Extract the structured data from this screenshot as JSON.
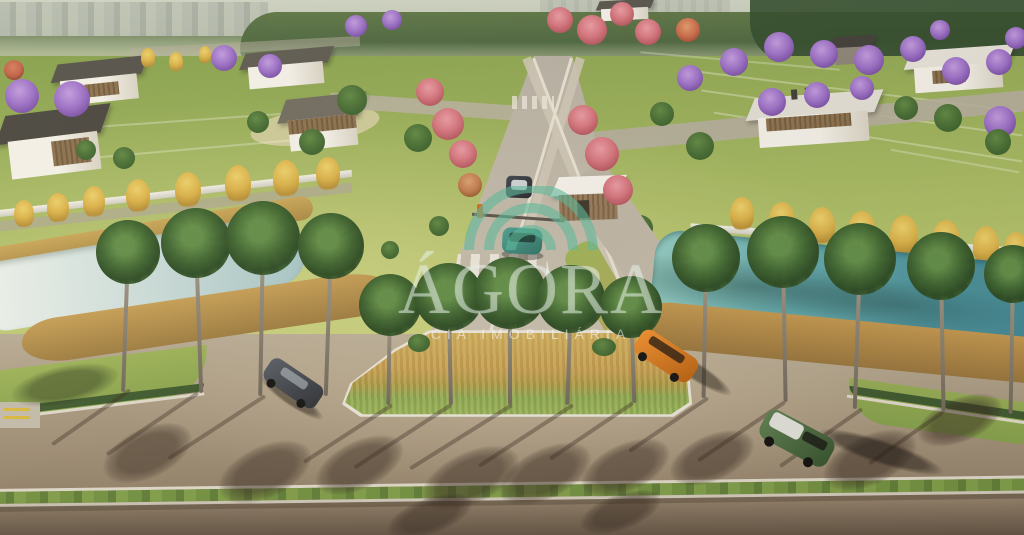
{
  "media": {
    "kind": "aerial 3D architectural rendering",
    "subject": "Entrance of a master-planned residential land development: tree-lined boulevard with gatehouse and crosswalk, central palm island, twin ornamental lakes with golden reed banks, perimeter wall and lots with modern flat-roof houses"
  },
  "watermark": {
    "brand": "ÁGORA",
    "tagline": "CIA IMOBILIÁRIA",
    "symbol": "three concentric arcs (signal-like logo)",
    "arc_color": "#5fb99b",
    "text_color": "rgba(226,237,226,0.52)"
  },
  "palette": {
    "lawn_green": "#a9bc66",
    "foreground_asphalt": "#9d8d76",
    "boulevard_concrete": "#c0b8a9",
    "lake_teal": "#47909c",
    "pond_light": "#cfdfdd",
    "reed_gold": "#c29a50",
    "jacaranda_purple": "#9b6fc9",
    "ipe_yellow": "#d9b148",
    "flowering_pink": "#d4737e",
    "palm_green": "#3c632f",
    "curb_white": "#e6e1d3",
    "median_grass": "#6f8f3f"
  },
  "vehicles": [
    {
      "name": "gray sedan",
      "hex": "#3a3f46",
      "location": "left access road"
    },
    {
      "name": "orange suv",
      "hex": "#d8781c",
      "location": "right access road"
    },
    {
      "name": "green suv with white roof",
      "hex": "#4f7046",
      "location": "lower right road"
    },
    {
      "name": "dark car with white roof",
      "hex": "#2b303a",
      "location": "boulevard, beyond gate"
    },
    {
      "name": "teal car",
      "hex": "#37897c",
      "location": "boulevard, at gate"
    }
  ],
  "vegetation": [
    "royal palms",
    "jacaranda trees (purple)",
    "ipê trees (yellow)",
    "pink flowering trees",
    "golden ornamental grasses",
    "clipped hedges"
  ],
  "features": [
    "entrance boulevard",
    "zebra crosswalk",
    "gatehouse",
    "gate barrier",
    "central island with palms",
    "grass median strip",
    "twin ornamental lakes",
    "white perimeter wall",
    "residential lots",
    "modern flat-roof houses",
    "distant city skyline"
  ]
}
